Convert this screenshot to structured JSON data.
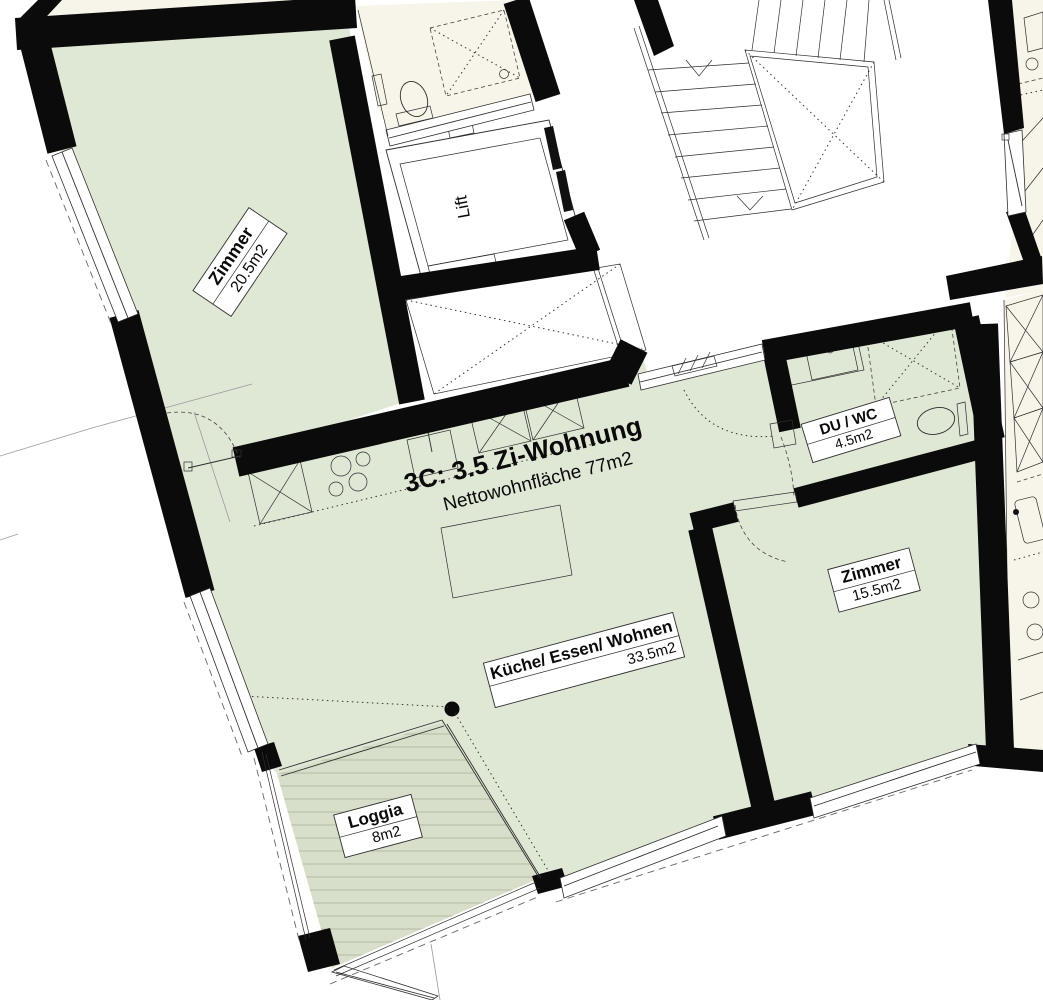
{
  "plan": {
    "title": "3C: 3.5 Zi-Wohnung",
    "subtitle": "Nettowohnfläche 77m2",
    "rooms": {
      "zimmer1": {
        "label": "Zimmer",
        "area": "20.5m2"
      },
      "living": {
        "label": "Küche/ Essen/ Wohnen",
        "area": "33.5m2"
      },
      "duwc": {
        "label": "DU / WC",
        "area": "4.5m2"
      },
      "zimmer2": {
        "label": "Zimmer",
        "area": "15.5m2"
      },
      "loggia": {
        "label": "Loggia",
        "area": "8m2"
      },
      "lift": {
        "label": "Lift"
      }
    },
    "colors": {
      "room_fill": "#dfe7d5",
      "loggia_fill": "#d7decа",
      "loggia_fill_hex": "#d7deca",
      "neighbor_fill": "#f7f4e9",
      "wall": "#0b0b0b"
    }
  }
}
